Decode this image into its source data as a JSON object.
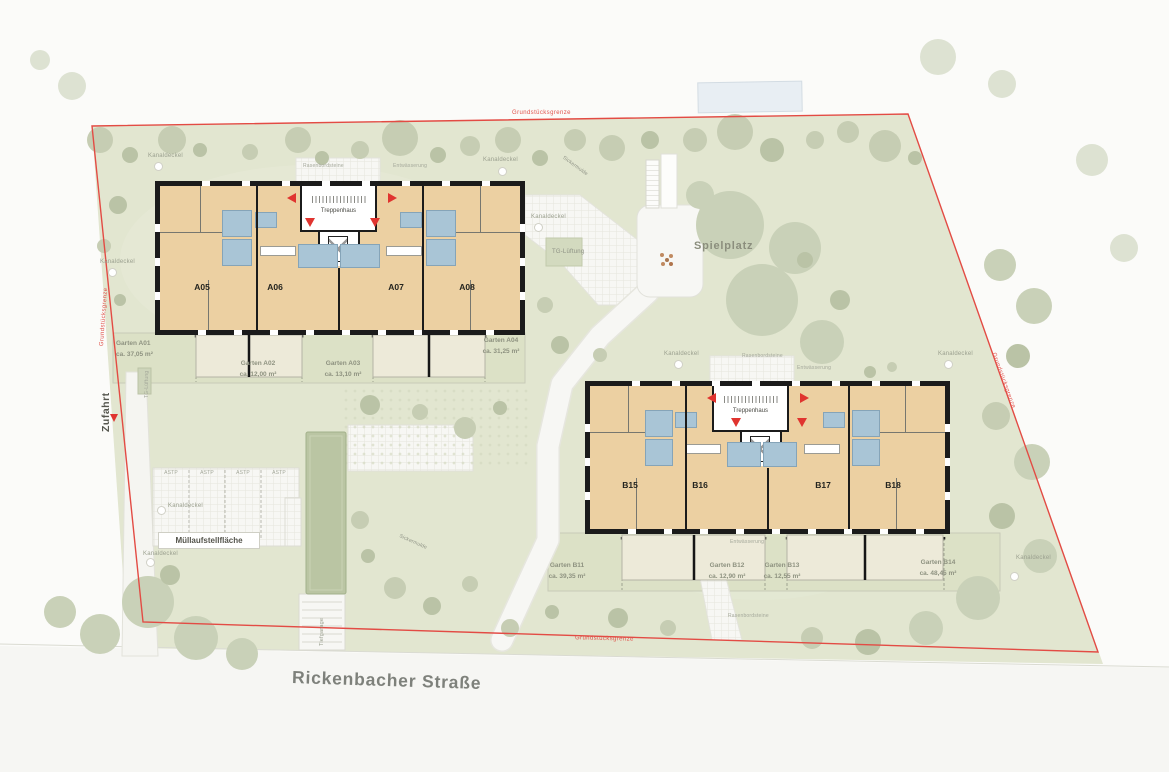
{
  "labels": {
    "boundary": "Grundstücksgrenze",
    "street": "Rickenbacher Straße",
    "playground": "Spielplatz",
    "driveway": "Zufahrt",
    "garage": "Tiefgarage",
    "garage_vent": "TG-Lüftung",
    "manhole": "Kanaldeckel",
    "drainage": "Entwässerung",
    "lawn_edge": "Rasenbordsteine",
    "swale": "Sickermulde",
    "waste_area": "Müllaufstellfläche",
    "parking_stall": "ASTP",
    "stairwell": "Treppenhaus",
    "elevator": "Aufzug"
  },
  "building_a": {
    "units": [
      "A05",
      "A06",
      "A07",
      "A08"
    ]
  },
  "building_b": {
    "units": [
      "B15",
      "B16",
      "B17",
      "B18"
    ]
  },
  "gardens_a": [
    {
      "name": "Garten A01",
      "area": "ca. 37,05 m²"
    },
    {
      "name": "Garten A02",
      "area": "ca. 12,00 m²"
    },
    {
      "name": "Garten A03",
      "area": "ca. 13,10 m²"
    },
    {
      "name": "Garten A04",
      "area": "ca. 31,25 m²"
    }
  ],
  "gardens_b": [
    {
      "name": "Garten B11",
      "area": "ca. 39,35 m²"
    },
    {
      "name": "Garten B12",
      "area": "ca. 12,90 m²"
    },
    {
      "name": "Garten B13",
      "area": "ca. 12,55 m²"
    },
    {
      "name": "Garten B14",
      "area": "ca. 48,45 m²"
    }
  ],
  "colors": {
    "boundary_red": "#e34b44",
    "wall_black": "#1b1b1b",
    "floor_tan": "#ecd0a2",
    "bath_blue": "#a9c5d6",
    "site_green": "#e2e6d0",
    "entrance_arrow_red": "#e0342f"
  }
}
